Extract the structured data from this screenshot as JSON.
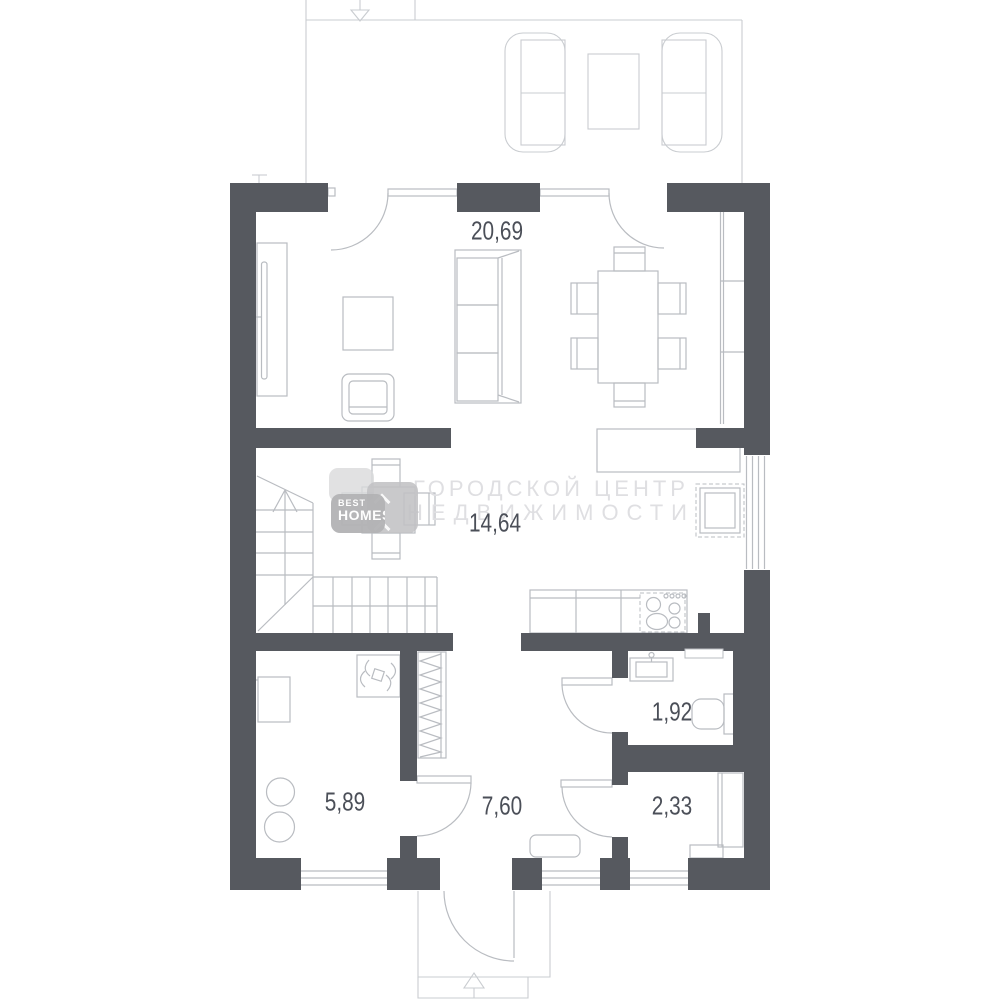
{
  "plan_title": "floor-plan",
  "labels": {
    "living": "20,69",
    "kitchen": "14,64",
    "laundry": "5,89",
    "hallway": "7,60",
    "wc": "1,92",
    "storage": "2,33"
  },
  "watermark": {
    "line1": "ГОРОДСКОЙ ЦЕНТР",
    "line2": "НЕДВИЖИМОСТИ"
  },
  "logo": {
    "top": "BEST",
    "bottom": "HOMES"
  },
  "colors": {
    "wall": "#56595f",
    "line": "#b9bcc1",
    "line_light": "#c9ccd0",
    "label": "#4b4f58",
    "watermark": "#dfdfe2",
    "logo_badge": "#b3b3b5"
  }
}
